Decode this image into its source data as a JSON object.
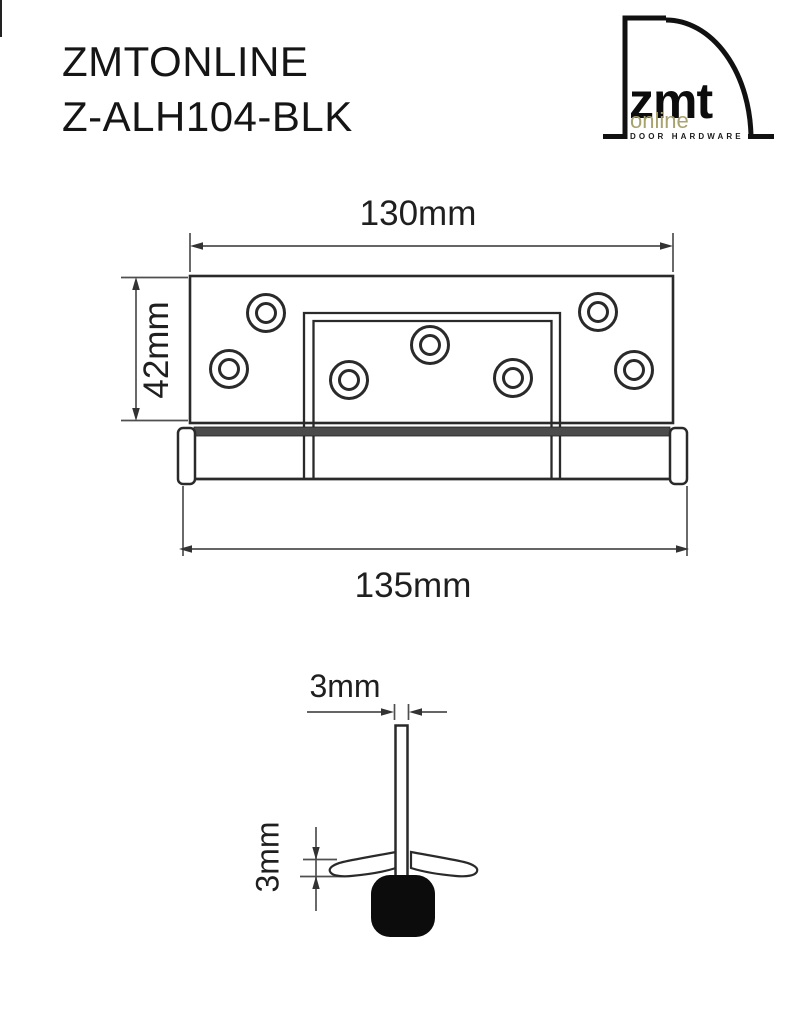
{
  "title": {
    "line1": "ZMTONLINE",
    "line2": "Z-ALH104-BLK"
  },
  "logo": {
    "brand": "zmt",
    "suffix": "online",
    "tagline": "DOOR HARDWARE",
    "accent_color": "#a8a26e"
  },
  "drawing": {
    "top_view": {
      "width_top": "130mm",
      "height_left": "42mm",
      "width_overall": "135mm",
      "screw_hole_count": 7
    },
    "side_view": {
      "leaf_thickness": "3mm",
      "flange_thickness": "3mm"
    }
  },
  "colors": {
    "outline": "#2a2a2a",
    "dimension": "#4f4f4f",
    "knuckle_band": "#4b4b4b",
    "end_cap_black": "#0c0c0c",
    "background": "#ffffff"
  }
}
